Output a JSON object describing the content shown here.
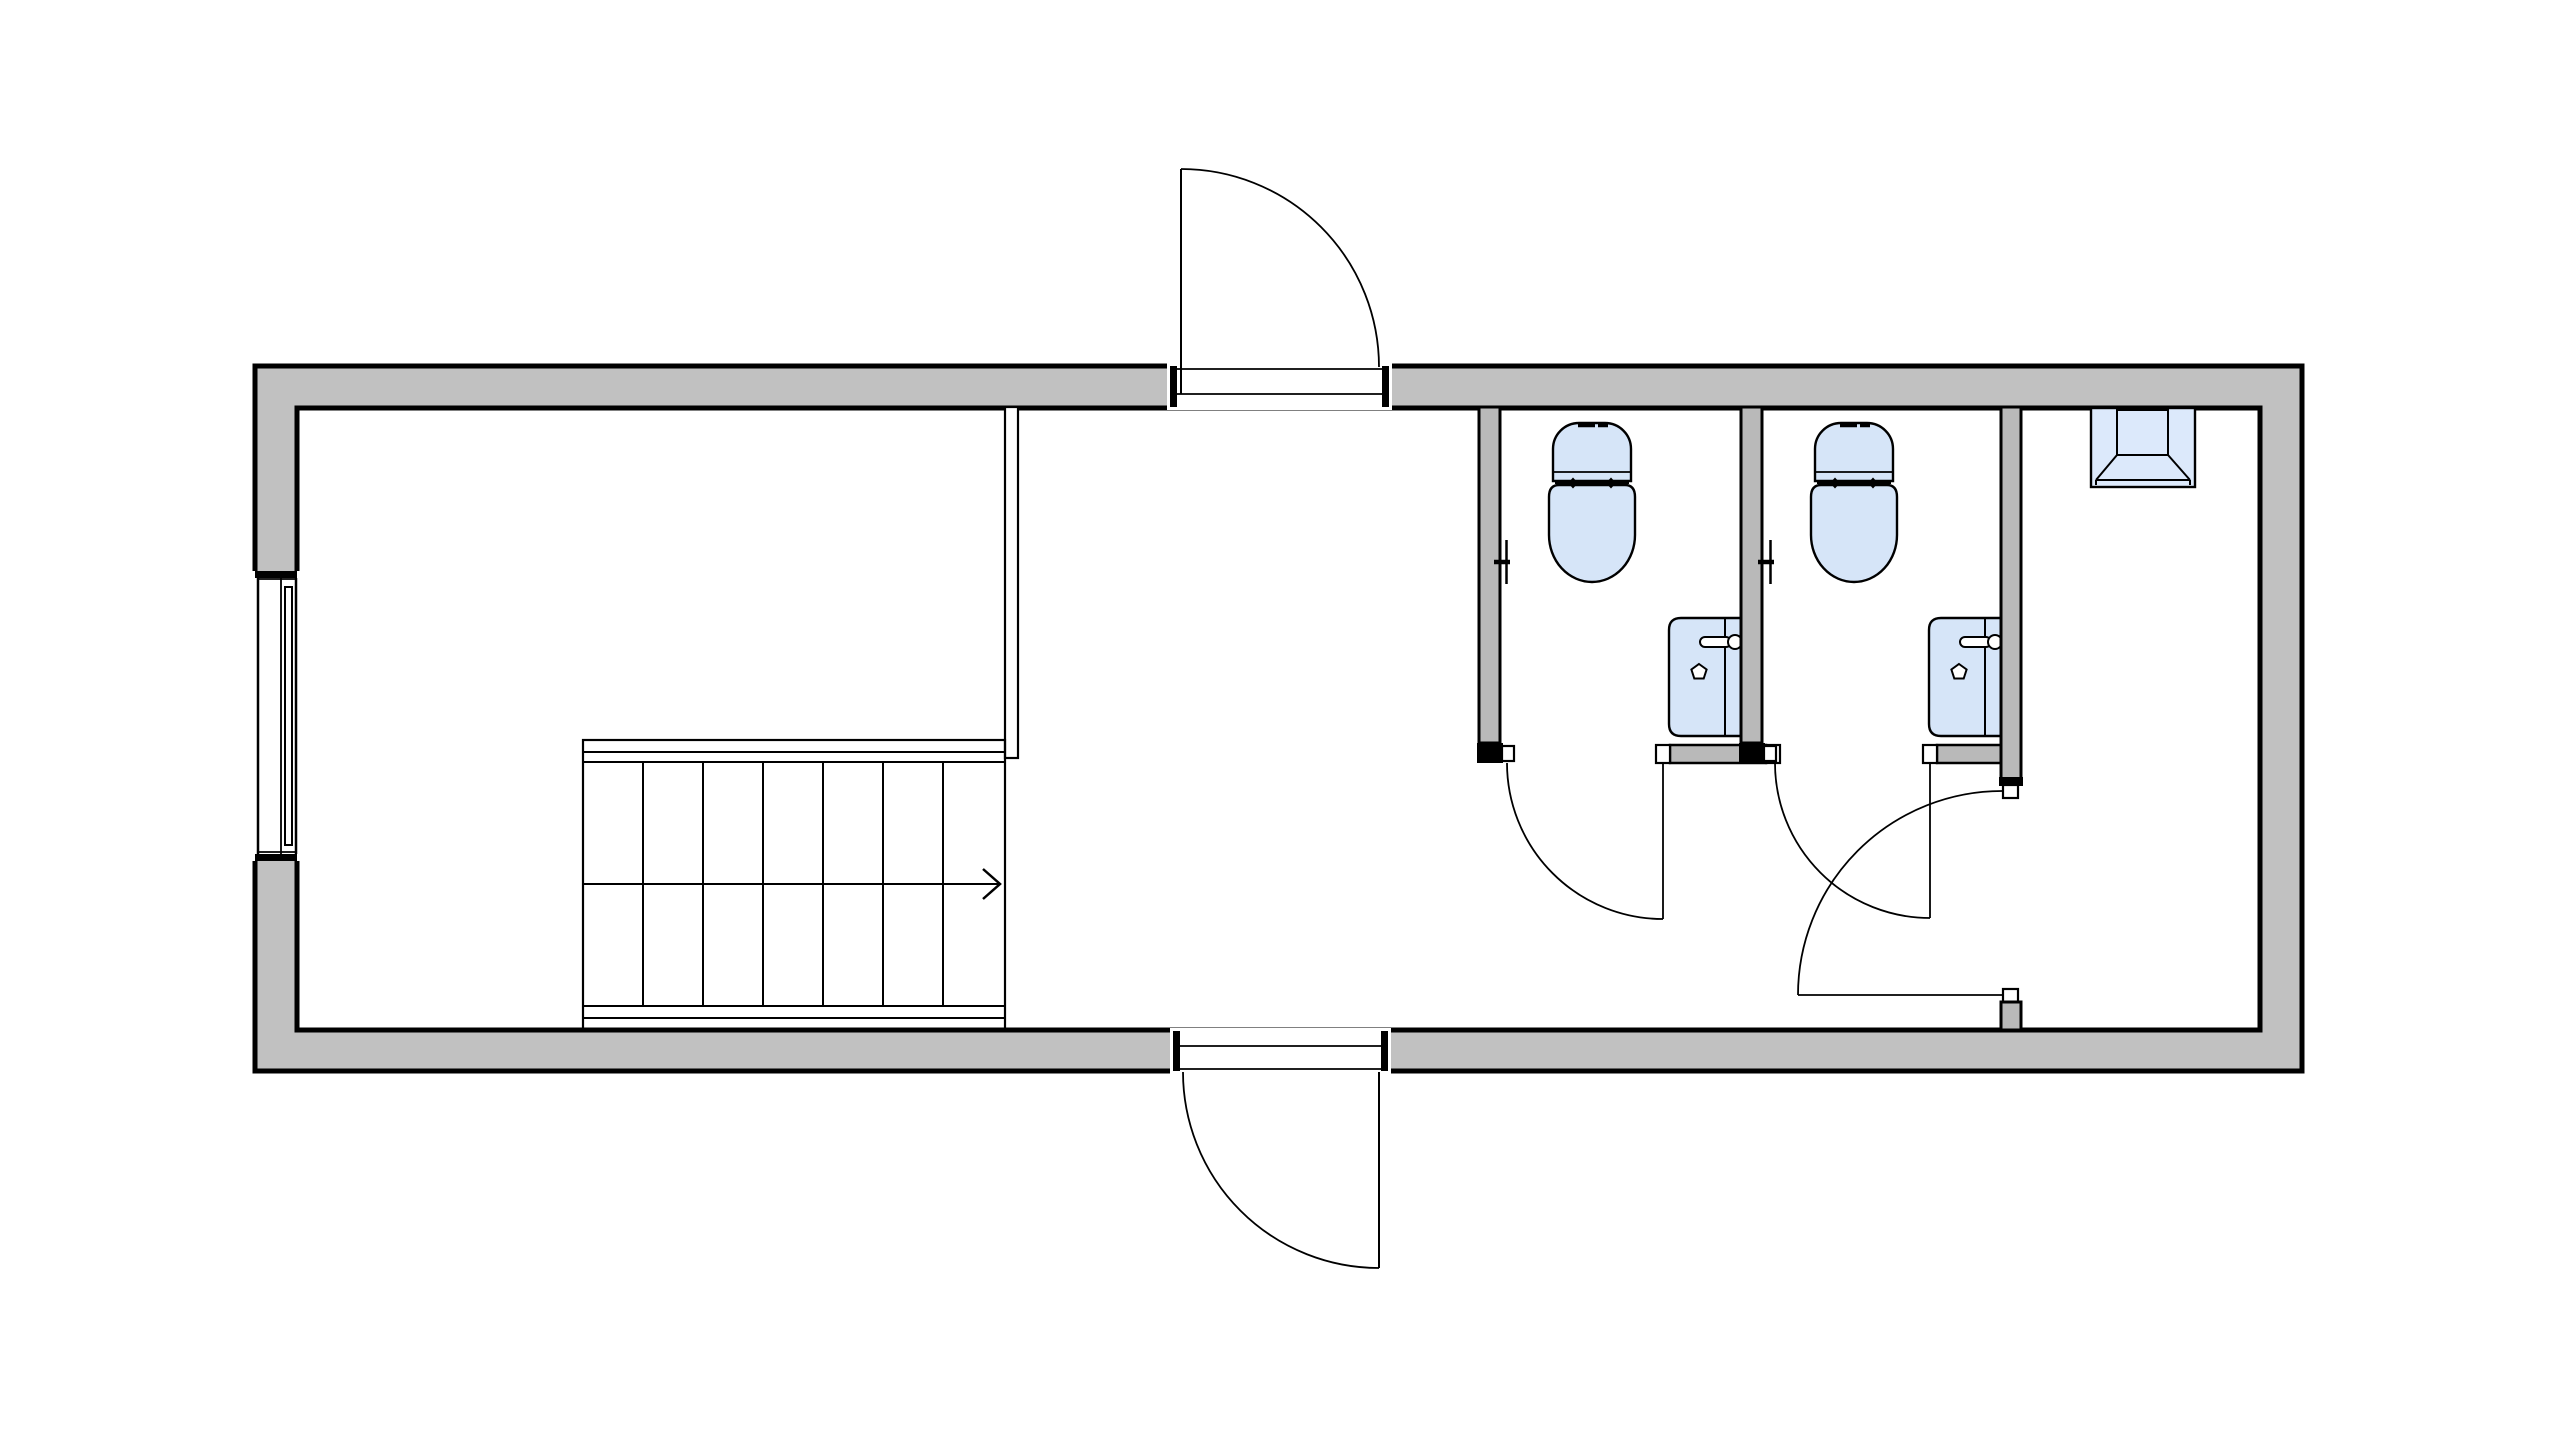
{
  "document": {
    "type": "architectural floor plan",
    "view": "2D plan view, no text labels, black line work on white background",
    "building_shape": "long rectangular unit with thick grey exterior walls"
  },
  "colors": {
    "background": "#ffffff",
    "line": "#000000",
    "wall_fill": "#c1c1c1",
    "partition_fill": "#b9b9b9",
    "fixture_fill": "#d6e5f8",
    "skylight_fill": "#dce9fb"
  },
  "inventory": {
    "rooms": [
      {
        "id": "left-room",
        "label": "large room at left with window on west wall and a straight staircase"
      },
      {
        "id": "entry-corridor",
        "label": "central corridor with opposite entry doors on north and south walls"
      },
      {
        "id": "wc-1",
        "label": "first toilet cubicle with toilet, wall-hung sink and paper holder"
      },
      {
        "id": "wc-2",
        "label": "second toilet cubicle with toilet, wall-hung sink and paper holder"
      },
      {
        "id": "right-room",
        "label": "small room at right with ceiling hatch / skylight symbol"
      }
    ],
    "doors": [
      {
        "id": "north-entry-door",
        "swing": "outward to the north, hinged on left jamb"
      },
      {
        "id": "south-entry-door",
        "swing": "outward to the south, hinged on right jamb"
      },
      {
        "id": "wc-1-door",
        "swing": "into corridor, hinged at sink stub wall"
      },
      {
        "id": "wc-2-door",
        "swing": "into corridor, hinged at sink stub wall"
      },
      {
        "id": "right-room-door",
        "swing": "into corridor, hinged at south stub of partition"
      }
    ],
    "windows": [
      {
        "id": "west-window",
        "label": "single window centered in west wall"
      }
    ],
    "fixtures": [
      {
        "id": "toilet-1",
        "type": "toilet, top view, light blue fill"
      },
      {
        "id": "toilet-2",
        "type": "toilet, top view, light blue fill"
      },
      {
        "id": "sink-1",
        "type": "rectangular sink with faucet and drain, light blue fill"
      },
      {
        "id": "sink-2",
        "type": "rectangular sink with faucet and drain, light blue fill"
      },
      {
        "id": "paper-holder-1",
        "type": "toilet paper holder symbol on cubicle partition"
      },
      {
        "id": "paper-holder-2",
        "type": "toilet paper holder symbol on cubicle partition"
      },
      {
        "id": "skylight",
        "type": "roof hatch / skylight symbol on north wall of right room"
      },
      {
        "id": "staircase",
        "type": "straight stair, 7 treads, centre direction line with arrow pointing right"
      }
    ]
  }
}
